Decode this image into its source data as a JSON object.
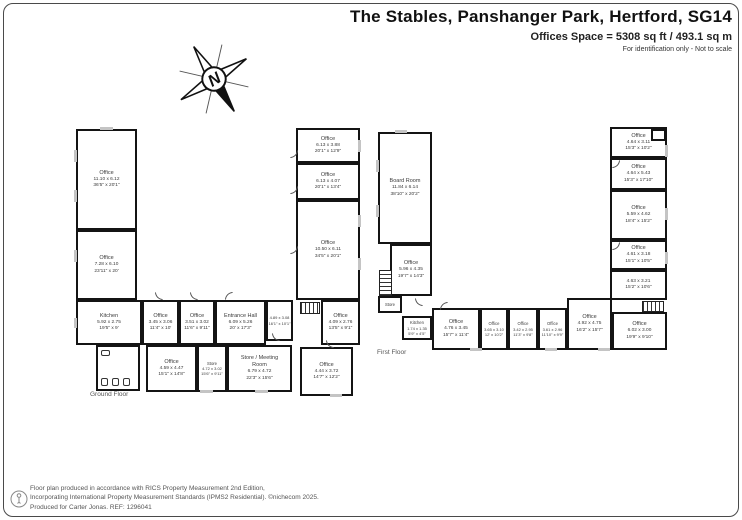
{
  "header": {
    "title": "The Stables, Panshanger Park, Hertford, SG14",
    "subtitle": "Offices Space = 5308 sq ft / 493.1 sq m",
    "note": "For identification only - Not to scale"
  },
  "compass": {
    "label": "N"
  },
  "ground_floor": {
    "label": "Ground Floor",
    "rooms": {
      "o1": {
        "name": "Office",
        "m": "11.10 x 6.12",
        "i": "36'5\" x 20'1\""
      },
      "o2": {
        "name": "Office",
        "m": "7.28 x 6.10",
        "i": "23'11\" x 20'"
      },
      "kitchen": {
        "name": "Kitchen",
        "m": "5.92 x 2.75",
        "i": "19'5\" x 9'"
      },
      "o3": {
        "name": "Office",
        "m": "3.45 x 3.06",
        "i": "11'4\" x 10'"
      },
      "o4": {
        "name": "Office",
        "m": "3.51 x 3.02",
        "i": "11'6\" x 9'11\""
      },
      "entrance": {
        "name": "Entrance Hall",
        "m": "6.09 x 5.26",
        "i": "20' x 17'3\""
      },
      "hall": {
        "m": "4.89 x 3.08",
        "i": "16'1\" x 10'1\""
      },
      "o5": {
        "name": "Office",
        "m": "4.09 x 2.76",
        "i": "13'5\" x 9'1\""
      },
      "o6": {
        "name": "Office",
        "m": "4.59 x 4.47",
        "i": "15'1\" x 14'8\""
      },
      "store": {
        "name": "Store",
        "m": "4.72 x 3.02",
        "i": "15'6\" x 9'11\""
      },
      "meeting": {
        "name": "Store / Meeting Room",
        "m": "6.79 x 4.72",
        "i": "22'3\" x 15'6\""
      },
      "o7": {
        "name": "Office",
        "m": "4.44 x 3.72",
        "i": "14'7\" x 12'2\""
      },
      "o8": {
        "name": "Office",
        "m": "6.13 x 3.88",
        "i": "20'1\" x 12'9\""
      },
      "o9": {
        "name": "Office",
        "m": "6.13 x 4.07",
        "i": "20'1\" x 13'4\""
      },
      "o10": {
        "name": "Office",
        "m": "10.50 x 6.11",
        "i": "34'5\" x 20'1\""
      }
    }
  },
  "first_floor": {
    "label": "First Floor",
    "rooms": {
      "board": {
        "name": "Board Room",
        "m": "11.84 x 6.14",
        "i": "38'10\" x 20'2\""
      },
      "o1": {
        "name": "Office",
        "m": "5.96 x 4.35",
        "i": "19'7\" x 14'3\""
      },
      "store": {
        "name": "Store"
      },
      "kitchen": {
        "name": "Kitchen",
        "m": "1.74 x 1.35",
        "i": "5'9\" x 4'5\""
      },
      "o2": {
        "name": "Office",
        "m": "4.76 x 3.45",
        "i": "15'7\" x 11'4\""
      },
      "o3": {
        "name": "Office",
        "m": "3.65 x 3.10",
        "i": "12' x 10'2\""
      },
      "o4": {
        "name": "Office",
        "m": "3.42 x 2.95",
        "i": "11'3\" x 9'8\""
      },
      "o5": {
        "name": "Office",
        "m": "3.61 x 2.96",
        "i": "11'10\" x 9'9\""
      },
      "o6": {
        "name": "Office",
        "m": "4.92 x 4.75",
        "i": "16'2\" x 15'7\""
      },
      "o7": {
        "name": "Office",
        "m": "6.02 x 3.00",
        "i": "19'9\" x 9'10\""
      },
      "o8": {
        "name": "Office",
        "m": "4.64 x 3.11",
        "i": "15'3\" x 10'2\""
      },
      "o9": {
        "name": "Office",
        "m": "4.64 x 5.43",
        "i": "15'3\" x 17'10\""
      },
      "o10": {
        "name": "Office",
        "m": "5.59 x 4.62",
        "i": "18'4\" x 15'2\""
      },
      "o11": {
        "name": "Office",
        "m": "4.61 x 3.18",
        "i": "15'1\" x 10'5\""
      },
      "r12": {
        "m": "4.63 x 3.21",
        "i": "15'2\" x 10'6\""
      }
    }
  },
  "footer": {
    "line1": "Floor plan produced in accordance with RICS Property Measurement 2nd Edition,",
    "line2": "Incorporating International Property Measurement Standards (IPMS2 Residential).  ©nichecom 2025.",
    "line3": "Produced for Carter Jonas.   REF: 1296041"
  }
}
